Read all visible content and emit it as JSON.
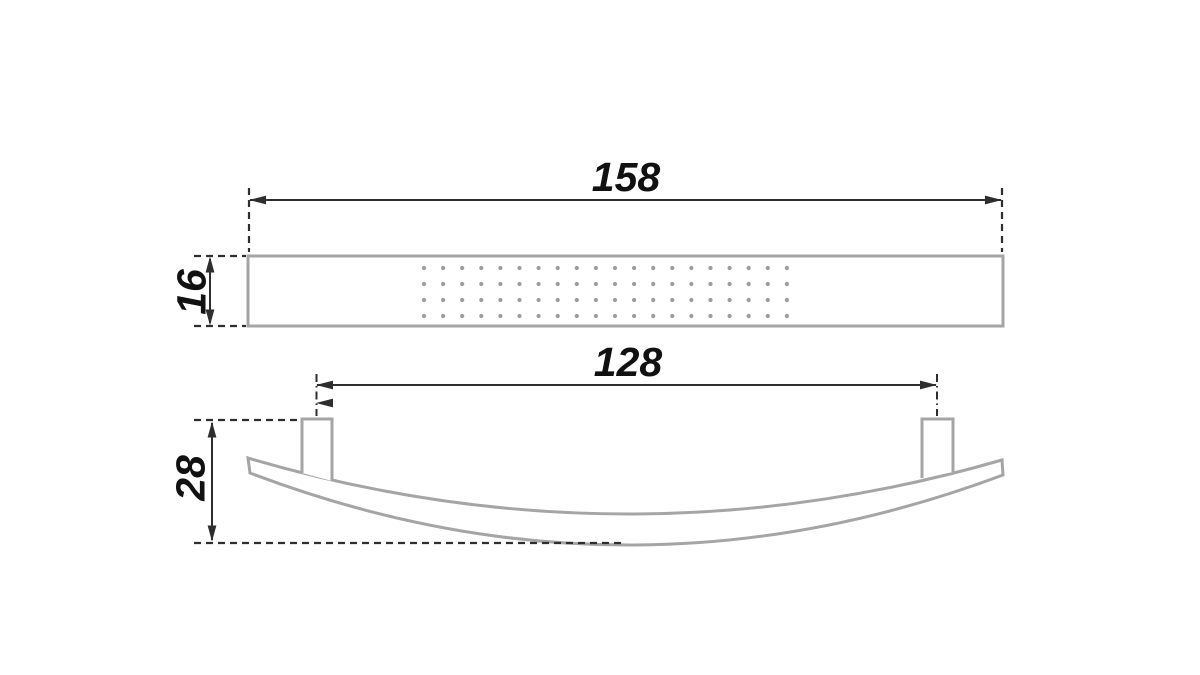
{
  "drawing": {
    "top_view": {
      "length_label": "158",
      "height_label": "16"
    },
    "front_view": {
      "spacing_label": "128",
      "height_label": "28"
    }
  },
  "colors": {
    "bg": "#ffffff",
    "outline": "#a5a5a5",
    "dots": "#9b9b9b",
    "dim": "#2e2e2e",
    "text": "#111111"
  }
}
